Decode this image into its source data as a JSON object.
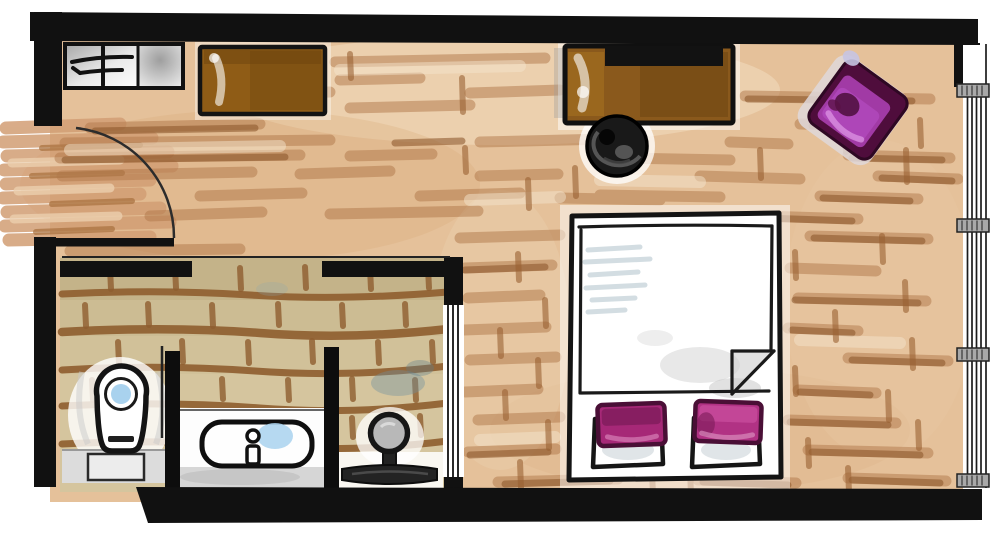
{
  "document": {
    "kind": "hand-drawn watercolor hotel-room floor plan",
    "visible_text": ""
  },
  "palette": {
    "wall": "#111111",
    "floor": "#e5c19a",
    "floorStroke": "#b1784a",
    "floorStrokeDark": "#8f5a2e",
    "floorLight": "#f3e3cc",
    "spill": "#d29e74",
    "tile": "#d5c59e",
    "tileBand": "#b3a174",
    "grout": "#8f5e2f",
    "waterBlue": "#a9d2ee",
    "smudgeBlue": "#70909e",
    "desk": "#8a591c",
    "dresser": "#8f5c16",
    "tv": "#121212",
    "chairBlack": "#191919",
    "armFrame": "#4f0d3c",
    "armSeat": "#a13aa5",
    "cushionLeft": "#a62877",
    "cushionRight": "#b13284",
    "cushionEdge": "#4a0f36",
    "mullion": "#a9a9a9",
    "fixtureGray": "#c4c4c4"
  },
  "plan": {
    "rooms": [
      {
        "name": "bedroom"
      },
      {
        "name": "bathroom"
      },
      {
        "name": "entry"
      }
    ],
    "furniture": [
      {
        "name": "luggage-bench"
      },
      {
        "name": "dresser"
      },
      {
        "name": "desk"
      },
      {
        "name": "tv"
      },
      {
        "name": "desk-chair"
      },
      {
        "name": "armchair"
      },
      {
        "name": "double-bed"
      },
      {
        "name": "bed-pillows"
      },
      {
        "name": "toilet"
      },
      {
        "name": "vanity-sink"
      },
      {
        "name": "shower"
      },
      {
        "name": "entry-door"
      },
      {
        "name": "bathroom-sliding-door"
      },
      {
        "name": "window-wall"
      }
    ]
  }
}
